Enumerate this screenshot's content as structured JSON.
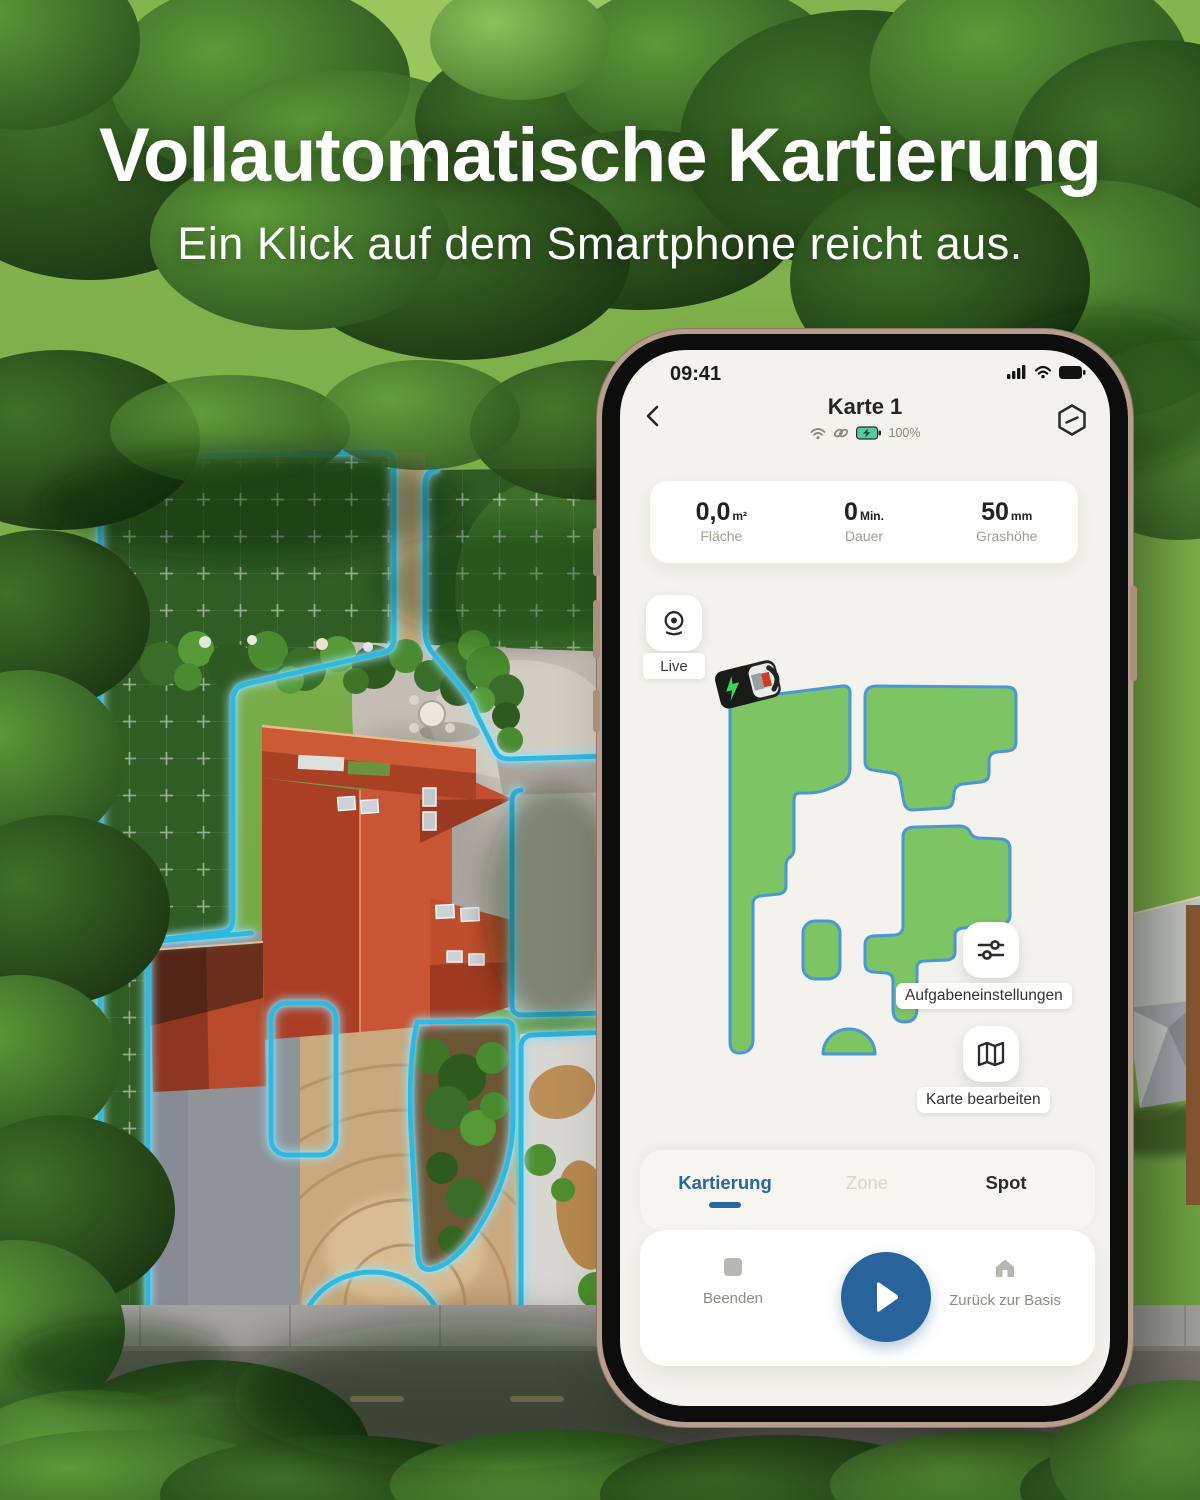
{
  "hero": {
    "title": "Vollautomatische Kartierung",
    "subtitle": "Ein Klick auf dem Smartphone reicht aus."
  },
  "phone": {
    "status": {
      "time": "09:41"
    },
    "header": {
      "title": "Karte 1",
      "battery": "100%"
    },
    "stats": {
      "items": [
        {
          "value": "0,0",
          "unit": "m²",
          "label": "Fläche"
        },
        {
          "value": "0",
          "unit": "Min.",
          "label": "Dauer"
        },
        {
          "value": "50",
          "unit": "mm",
          "label": "Grashöhe"
        }
      ]
    },
    "live": {
      "label": "Live"
    },
    "map": {
      "task_settings_label": "Aufgabeneinstellungen",
      "edit_map_label": "Karte bearbeiten"
    },
    "tabs": {
      "items": [
        {
          "label": "Kartierung"
        },
        {
          "label": "Zone"
        },
        {
          "label": "Spot"
        }
      ],
      "active_index": 0
    },
    "controls": {
      "stop": "Beenden",
      "home": "Zurück zur Basis"
    }
  },
  "icons": {
    "back": "chevron-left",
    "dock": "hexagon-slash",
    "live": "camera",
    "connectivity": [
      "wifi",
      "link",
      "battery-charging"
    ],
    "status_bar": [
      "signal-bars",
      "wifi",
      "battery"
    ],
    "task_settings": "sliders",
    "edit_map": "folded-map",
    "stop": "square",
    "play": "play-triangle",
    "home": "house"
  },
  "colors": {
    "zone_fill": "#7CC464",
    "zone_stroke": "#4B96D8",
    "outline_cyan": "#2FB9E2",
    "tab_active": "#28679C",
    "play_button": "#28639B",
    "battery_chip": "#57C8A4",
    "screen_bg": "#F3F2EC"
  }
}
